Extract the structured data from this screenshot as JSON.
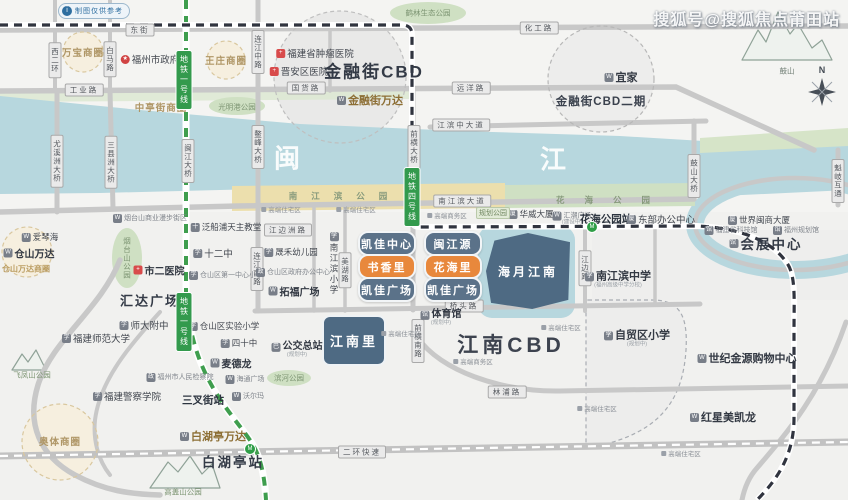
{
  "app": {
    "watermark": "搜狐号@搜狐焦点莆田站",
    "badge_icon": "i",
    "badge_text": "制图仅供参考",
    "compass_label": "N"
  },
  "river": {
    "chars": [
      {
        "t": "闽",
        "x": 287,
        "y": 157
      },
      {
        "t": "江",
        "x": 553,
        "y": 158
      }
    ]
  },
  "metro_tags": [
    {
      "t": "地铁一号线",
      "x": 184,
      "y": 80
    },
    {
      "t": "地铁一号线",
      "x": 184,
      "y": 322
    },
    {
      "t": "地铁四号线",
      "x": 412,
      "y": 197
    }
  ],
  "metro_icons": [
    {
      "t": "M",
      "x": 592,
      "y": 227
    },
    {
      "t": "M",
      "x": 250,
      "y": 449
    }
  ],
  "road_labels": [
    {
      "t": "东街",
      "x": 140,
      "y": 30
    },
    {
      "t": "工业路",
      "x": 84,
      "y": 90
    },
    {
      "t": "国货路",
      "x": 306,
      "y": 88
    },
    {
      "t": "化工路",
      "x": 539,
      "y": 28
    },
    {
      "t": "远洋路",
      "x": 471,
      "y": 88
    },
    {
      "t": "江滨中大道",
      "x": 461,
      "y": 125
    },
    {
      "t": "南江滨大道",
      "x": 462,
      "y": 201
    },
    {
      "t": "江边洲路",
      "x": 288,
      "y": 230
    },
    {
      "t": "桥头路",
      "x": 464,
      "y": 306
    },
    {
      "t": "林浦路",
      "x": 507,
      "y": 392
    },
    {
      "t": "二环快速",
      "x": 362,
      "y": 452
    },
    {
      "t": "西二环",
      "x": 55,
      "y": 60,
      "v": true
    },
    {
      "t": "白马路",
      "x": 110,
      "y": 59,
      "v": true
    },
    {
      "t": "连江中路",
      "x": 258,
      "y": 52,
      "v": true
    },
    {
      "t": "尤溪洲大桥",
      "x": 57,
      "y": 161,
      "v": true
    },
    {
      "t": "三县洲大桥",
      "x": 111,
      "y": 162,
      "v": true
    },
    {
      "t": "闽江大桥",
      "x": 188,
      "y": 161,
      "v": true
    },
    {
      "t": "鳌峰大桥",
      "x": 258,
      "y": 147,
      "v": true
    },
    {
      "t": "前横大桥",
      "x": 414,
      "y": 147,
      "v": true
    },
    {
      "t": "鼓山大桥",
      "x": 694,
      "y": 176,
      "v": true
    },
    {
      "t": "魁岐互通",
      "x": 838,
      "y": 181,
      "v": true
    },
    {
      "t": "连江南路",
      "x": 257,
      "y": 269,
      "v": true
    },
    {
      "t": "美湖路",
      "x": 345,
      "y": 270,
      "v": true
    },
    {
      "t": "江边路",
      "x": 585,
      "y": 268,
      "v": true
    },
    {
      "t": "前横南路",
      "x": 418,
      "y": 341,
      "v": true
    }
  ],
  "park_labels": [
    {
      "t": "鹤林生态公园",
      "x": 428,
      "y": 13
    },
    {
      "t": "光明港公园",
      "x": 237,
      "y": 107
    },
    {
      "t": "烟台山公园",
      "x": 127,
      "y": 258,
      "v": true
    },
    {
      "t": "滨河公园",
      "x": 289,
      "y": 378
    },
    {
      "t": "飞凤山公园",
      "x": 32,
      "y": 375
    },
    {
      "t": "高盖山公园",
      "x": 183,
      "y": 492
    }
  ],
  "spread_labels": [
    {
      "t": "南江滨公园",
      "x": 345,
      "y": 196,
      "ls": 14
    },
    {
      "t": "花海公园",
      "x": 613,
      "y": 200,
      "ls": 20
    }
  ],
  "mountain_labels": [
    {
      "t": "鼓山",
      "x": 787,
      "y": 71
    }
  ],
  "circles": [
    {
      "x": 340,
      "y": 77,
      "r": 66,
      "k": "gray"
    },
    {
      "x": 601,
      "y": 79,
      "r": 53,
      "k": "gray2"
    },
    {
      "x": 83,
      "y": 52,
      "r": 20,
      "k": "tan"
    },
    {
      "x": 226,
      "y": 60,
      "r": 19,
      "k": "tan"
    },
    {
      "x": 27,
      "y": 252,
      "r": 25,
      "k": "tan"
    },
    {
      "x": 60,
      "y": 442,
      "r": 38,
      "k": "tan"
    }
  ],
  "projects": {
    "boxes": [
      {
        "t": "凯佳中心",
        "x": 358,
        "y": 231,
        "w": 54,
        "h": 21,
        "c": "slate"
      },
      {
        "t": "书香里",
        "x": 358,
        "y": 254,
        "w": 54,
        "h": 21,
        "c": "orange"
      },
      {
        "t": "凯佳广场",
        "x": 358,
        "y": 277,
        "w": 54,
        "h": 21,
        "c": "slate"
      },
      {
        "t": "闽江源",
        "x": 424,
        "y": 231,
        "w": 54,
        "h": 21,
        "c": "slate"
      },
      {
        "t": "花海里",
        "x": 424,
        "y": 254,
        "w": 54,
        "h": 21,
        "c": "orange"
      },
      {
        "t": "凯佳广场",
        "x": 424,
        "y": 277,
        "w": 54,
        "h": 21,
        "c": "slate"
      }
    ],
    "estates": [
      {
        "t": "江南里",
        "x": 322,
        "y": 315,
        "w": 60,
        "h": 47,
        "fs": 13,
        "shape": "r8"
      },
      {
        "t": "海月江南",
        "x": 486,
        "y": 233,
        "w": 84,
        "h": 76,
        "fs": 12,
        "shape": "poly"
      }
    ]
  },
  "pois": [
    {
      "t": "福州市政府",
      "x": 150,
      "y": 59,
      "s": "poi9",
      "ic": "gov"
    },
    {
      "t": "福建省肿瘤医院",
      "x": 315,
      "y": 53,
      "s": "poi9",
      "ic": "hosp"
    },
    {
      "t": "晋安区医院",
      "x": 299,
      "y": 71,
      "s": "poi9",
      "ic": "hosp"
    },
    {
      "t": "金融街CBD",
      "x": 374,
      "y": 70,
      "s": "big17"
    },
    {
      "t": "金融街万达",
      "x": 370,
      "y": 100,
      "s": "goldb",
      "ic": "shop"
    },
    {
      "t": "宜家",
      "x": 621,
      "y": 77,
      "s": "bold11",
      "ic": "shop"
    },
    {
      "t": "金融街CBD二期",
      "x": 601,
      "y": 101,
      "s": "big11"
    },
    {
      "t": "万宝商圈",
      "x": 83,
      "y": 52,
      "s": "gold9"
    },
    {
      "t": "王庄商圈",
      "x": 226,
      "y": 60,
      "s": "gold9"
    },
    {
      "t": "中亭街商圈",
      "x": 161,
      "y": 107,
      "s": "gold9"
    },
    {
      "t": "爱琴海",
      "x": 40,
      "y": 237,
      "s": "poi8",
      "ic": "shop"
    },
    {
      "t": "仓山万达",
      "x": 29,
      "y": 253,
      "s": "bold10",
      "ic": "shop"
    },
    {
      "t": "仓山万达商圈",
      "x": 26,
      "y": 269,
      "s": "gold8"
    },
    {
      "t": "烟台山商业漫步街区",
      "x": 150,
      "y": 218,
      "s": "tiny7",
      "ic": "shop"
    },
    {
      "t": "泛船浦天主教堂",
      "x": 226,
      "y": 227,
      "s": "poi8",
      "ic": "church"
    },
    {
      "t": "十二中",
      "x": 213,
      "y": 253,
      "s": "poi9",
      "ic": "school"
    },
    {
      "t": "仓山区第一中心小学",
      "x": 226,
      "y": 275,
      "s": "tiny7",
      "ic": "school"
    },
    {
      "t": "市二医院",
      "x": 159,
      "y": 270,
      "s": "bold10",
      "ic": "hosp"
    },
    {
      "t": "汇达广场",
      "x": 150,
      "y": 300,
      "s": "big12"
    },
    {
      "t": "师大附中",
      "x": 144,
      "y": 325,
      "s": "poi9",
      "ic": "school"
    },
    {
      "t": "福建师范大学",
      "x": 96,
      "y": 338,
      "s": "poi9",
      "ic": "school"
    },
    {
      "t": "仓山区实验小学",
      "x": 224,
      "y": 326,
      "s": "poi8",
      "ic": "school"
    },
    {
      "t": "四十中",
      "x": 239,
      "y": 343,
      "s": "poi8",
      "ic": "school"
    },
    {
      "t": "麦德龙",
      "x": 231,
      "y": 363,
      "s": "bold10",
      "ic": "shop"
    },
    {
      "t": "海通广场",
      "x": 245,
      "y": 379,
      "s": "tiny7",
      "ic": "shop"
    },
    {
      "t": "福州市人民检察院",
      "x": 180,
      "y": 377,
      "s": "tiny7",
      "ic": "gov2"
    },
    {
      "t": "福建警察学院",
      "x": 127,
      "y": 396,
      "s": "poi9",
      "ic": "school"
    },
    {
      "t": "三叉街站",
      "x": 203,
      "y": 400,
      "s": "station"
    },
    {
      "t": "沃尔玛",
      "x": 248,
      "y": 396,
      "s": "tiny7",
      "ic": "shop"
    },
    {
      "t": "白湖亭万达",
      "x": 213,
      "y": 436,
      "s": "goldb",
      "ic": "shop"
    },
    {
      "t": "白湖亭站",
      "x": 233,
      "y": 461,
      "s": "big13"
    },
    {
      "t": "奥体商圈",
      "x": 60,
      "y": 441,
      "s": "gold9"
    },
    {
      "t": "公交总站",
      "x": 297,
      "y": 350,
      "s": "bold10",
      "ic": "bus",
      "sub": "(规划中)"
    },
    {
      "t": "晟禾幼儿园",
      "x": 291,
      "y": 252,
      "s": "poi8",
      "ic": "school"
    },
    {
      "t": "仓山区政府办公中心",
      "x": 293,
      "y": 272,
      "s": "tiny7",
      "ic": "gov2"
    },
    {
      "t": "拓福广场",
      "x": 294,
      "y": 291,
      "s": "bold10",
      "ic": "shop"
    },
    {
      "t": "南江滨小学",
      "x": 334,
      "y": 264,
      "s": "poi8",
      "ic": "school",
      "v": true
    },
    {
      "t": "体育馆",
      "x": 441,
      "y": 318,
      "s": "bold10",
      "ic": "mus",
      "sub": "(规划中)"
    },
    {
      "t": "江南CBD",
      "x": 511,
      "y": 344,
      "s": "big20"
    },
    {
      "t": "南江滨中学",
      "x": 618,
      "y": 280,
      "s": "bold11",
      "ic": "school",
      "sub": "(福州高级中学分校)"
    },
    {
      "t": "华威大厦",
      "x": 531,
      "y": 214,
      "s": "poi8",
      "ic": "bldg"
    },
    {
      "t": "汇潮广场",
      "x": 572,
      "y": 219,
      "s": "tiny7",
      "ic": "shop",
      "sub": "(建设中)"
    },
    {
      "t": "花海公园站",
      "x": 606,
      "y": 219,
      "s": "station"
    },
    {
      "t": "东部办公中心",
      "x": 661,
      "y": 219,
      "s": "poi9",
      "ic": "bldg"
    },
    {
      "t": "规划公园",
      "x": 493,
      "y": 213,
      "s": "plan"
    },
    {
      "t": "世界闽商大厦",
      "x": 759,
      "y": 220,
      "s": "poi8",
      "ic": "bldg"
    },
    {
      "t": "福建省科技馆",
      "x": 731,
      "y": 230,
      "s": "tiny7",
      "ic": "mus"
    },
    {
      "t": "福州规划馆",
      "x": 796,
      "y": 230,
      "s": "tiny7",
      "ic": "mus"
    },
    {
      "t": "会展中心",
      "x": 766,
      "y": 243,
      "s": "big13",
      "ic": "mus"
    },
    {
      "t": "自贸区小学",
      "x": 637,
      "y": 339,
      "s": "bold11",
      "ic": "school",
      "sub": "(规划中)"
    },
    {
      "t": "世纪金源购物中心",
      "x": 747,
      "y": 358,
      "s": "bold11",
      "ic": "shop"
    },
    {
      "t": "红星美凯龙",
      "x": 723,
      "y": 417,
      "s": "bold11",
      "ic": "shop"
    },
    {
      "t": "高端住宅区",
      "x": 281,
      "y": 209,
      "s": "tiny6",
      "ic": "dot"
    },
    {
      "t": "高端住宅区",
      "x": 356,
      "y": 209,
      "s": "tiny6",
      "ic": "dot"
    },
    {
      "t": "高端商务区",
      "x": 447,
      "y": 215,
      "s": "tiny6",
      "ic": "dot"
    },
    {
      "t": "高端住宅区",
      "x": 401,
      "y": 333,
      "s": "tiny6",
      "ic": "dot"
    },
    {
      "t": "高端住宅区",
      "x": 561,
      "y": 327,
      "s": "tiny6",
      "ic": "dot"
    },
    {
      "t": "高端商务区",
      "x": 473,
      "y": 361,
      "s": "tiny6",
      "ic": "dot"
    },
    {
      "t": "高端住宅区",
      "x": 597,
      "y": 408,
      "s": "tiny6",
      "ic": "dot"
    },
    {
      "t": "高端住宅区",
      "x": 681,
      "y": 453,
      "s": "tiny6",
      "ic": "dot"
    }
  ]
}
